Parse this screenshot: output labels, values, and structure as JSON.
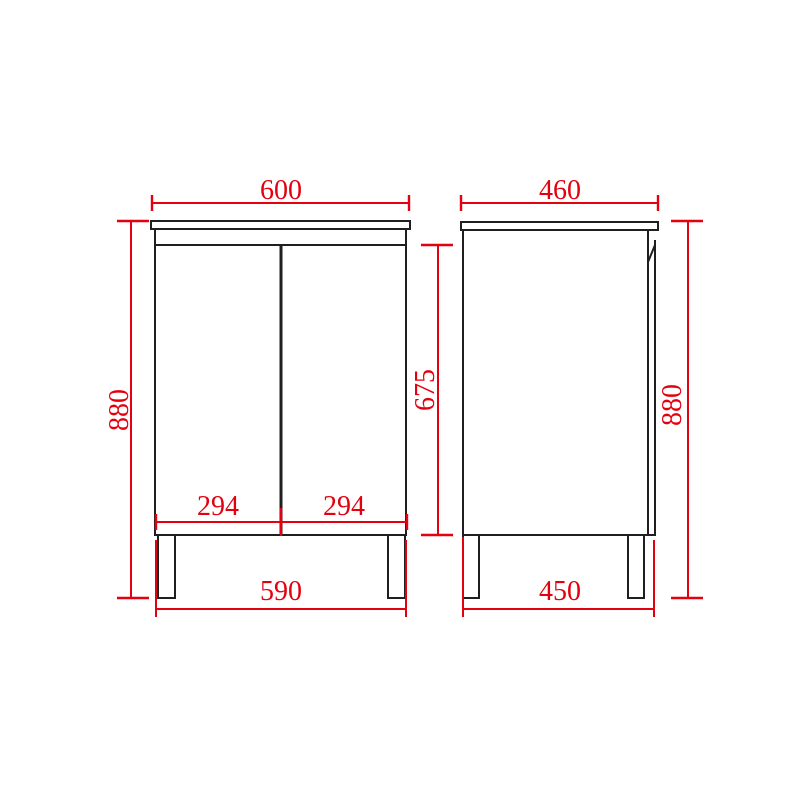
{
  "drawing": {
    "subject": "two-door vanity cabinet dimension drawing, front and side views",
    "background_color": "#ffffff",
    "line_color": "#1f1f1f",
    "dimension_color": "#e4000f",
    "front_view": {
      "dims": {
        "top_width": {
          "value": "600"
        },
        "overall_height": {
          "value": "880"
        },
        "door_height": {
          "value": "675"
        },
        "left_door_width": {
          "value": "294"
        },
        "right_door_width": {
          "value": "294"
        },
        "leg_span_width": {
          "value": "590"
        }
      }
    },
    "side_view": {
      "dims": {
        "top_depth": {
          "value": "460"
        },
        "overall_height": {
          "value": "880"
        },
        "leg_span_depth": {
          "value": "450"
        }
      }
    }
  }
}
